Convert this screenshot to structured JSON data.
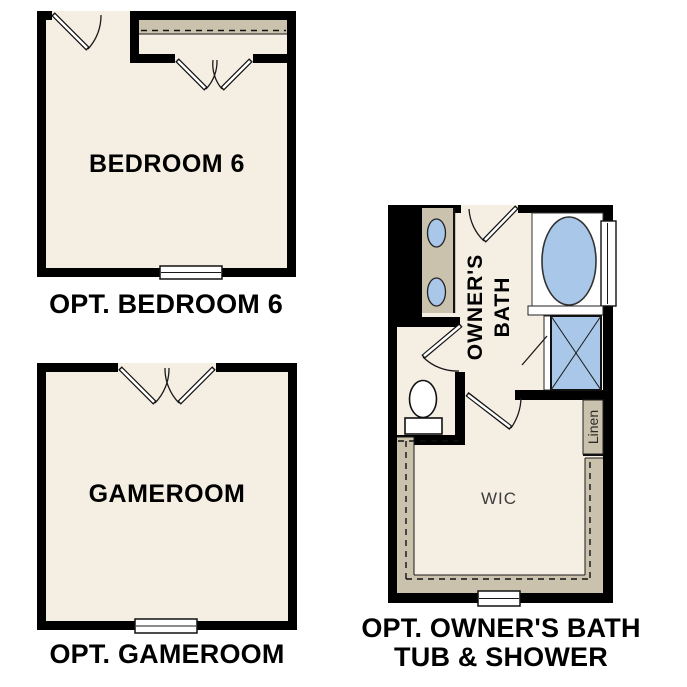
{
  "colors": {
    "floor": "#f5efe3",
    "wall": "#000000",
    "cabinet": "#cbc2ad",
    "fixture": "#a9c7e9",
    "paper": "#ffffff",
    "line": "#1a1a1a",
    "label": "#000000",
    "room-label": "#3d3d3d"
  },
  "plans": {
    "bedroom6": {
      "room_label": "BEDROOM 6",
      "caption": "OPT. BEDROOM 6"
    },
    "gameroom": {
      "room_label": "GAMEROOM",
      "caption": "OPT. GAMEROOM"
    },
    "owners_bath": {
      "room_label_line1": "OWNER'S",
      "room_label_line2": "BATH",
      "wic_label": "WIC",
      "linen_label": "Linen",
      "caption_line1": "OPT. OWNER'S BATH",
      "caption_line2": "TUB & SHOWER"
    }
  }
}
